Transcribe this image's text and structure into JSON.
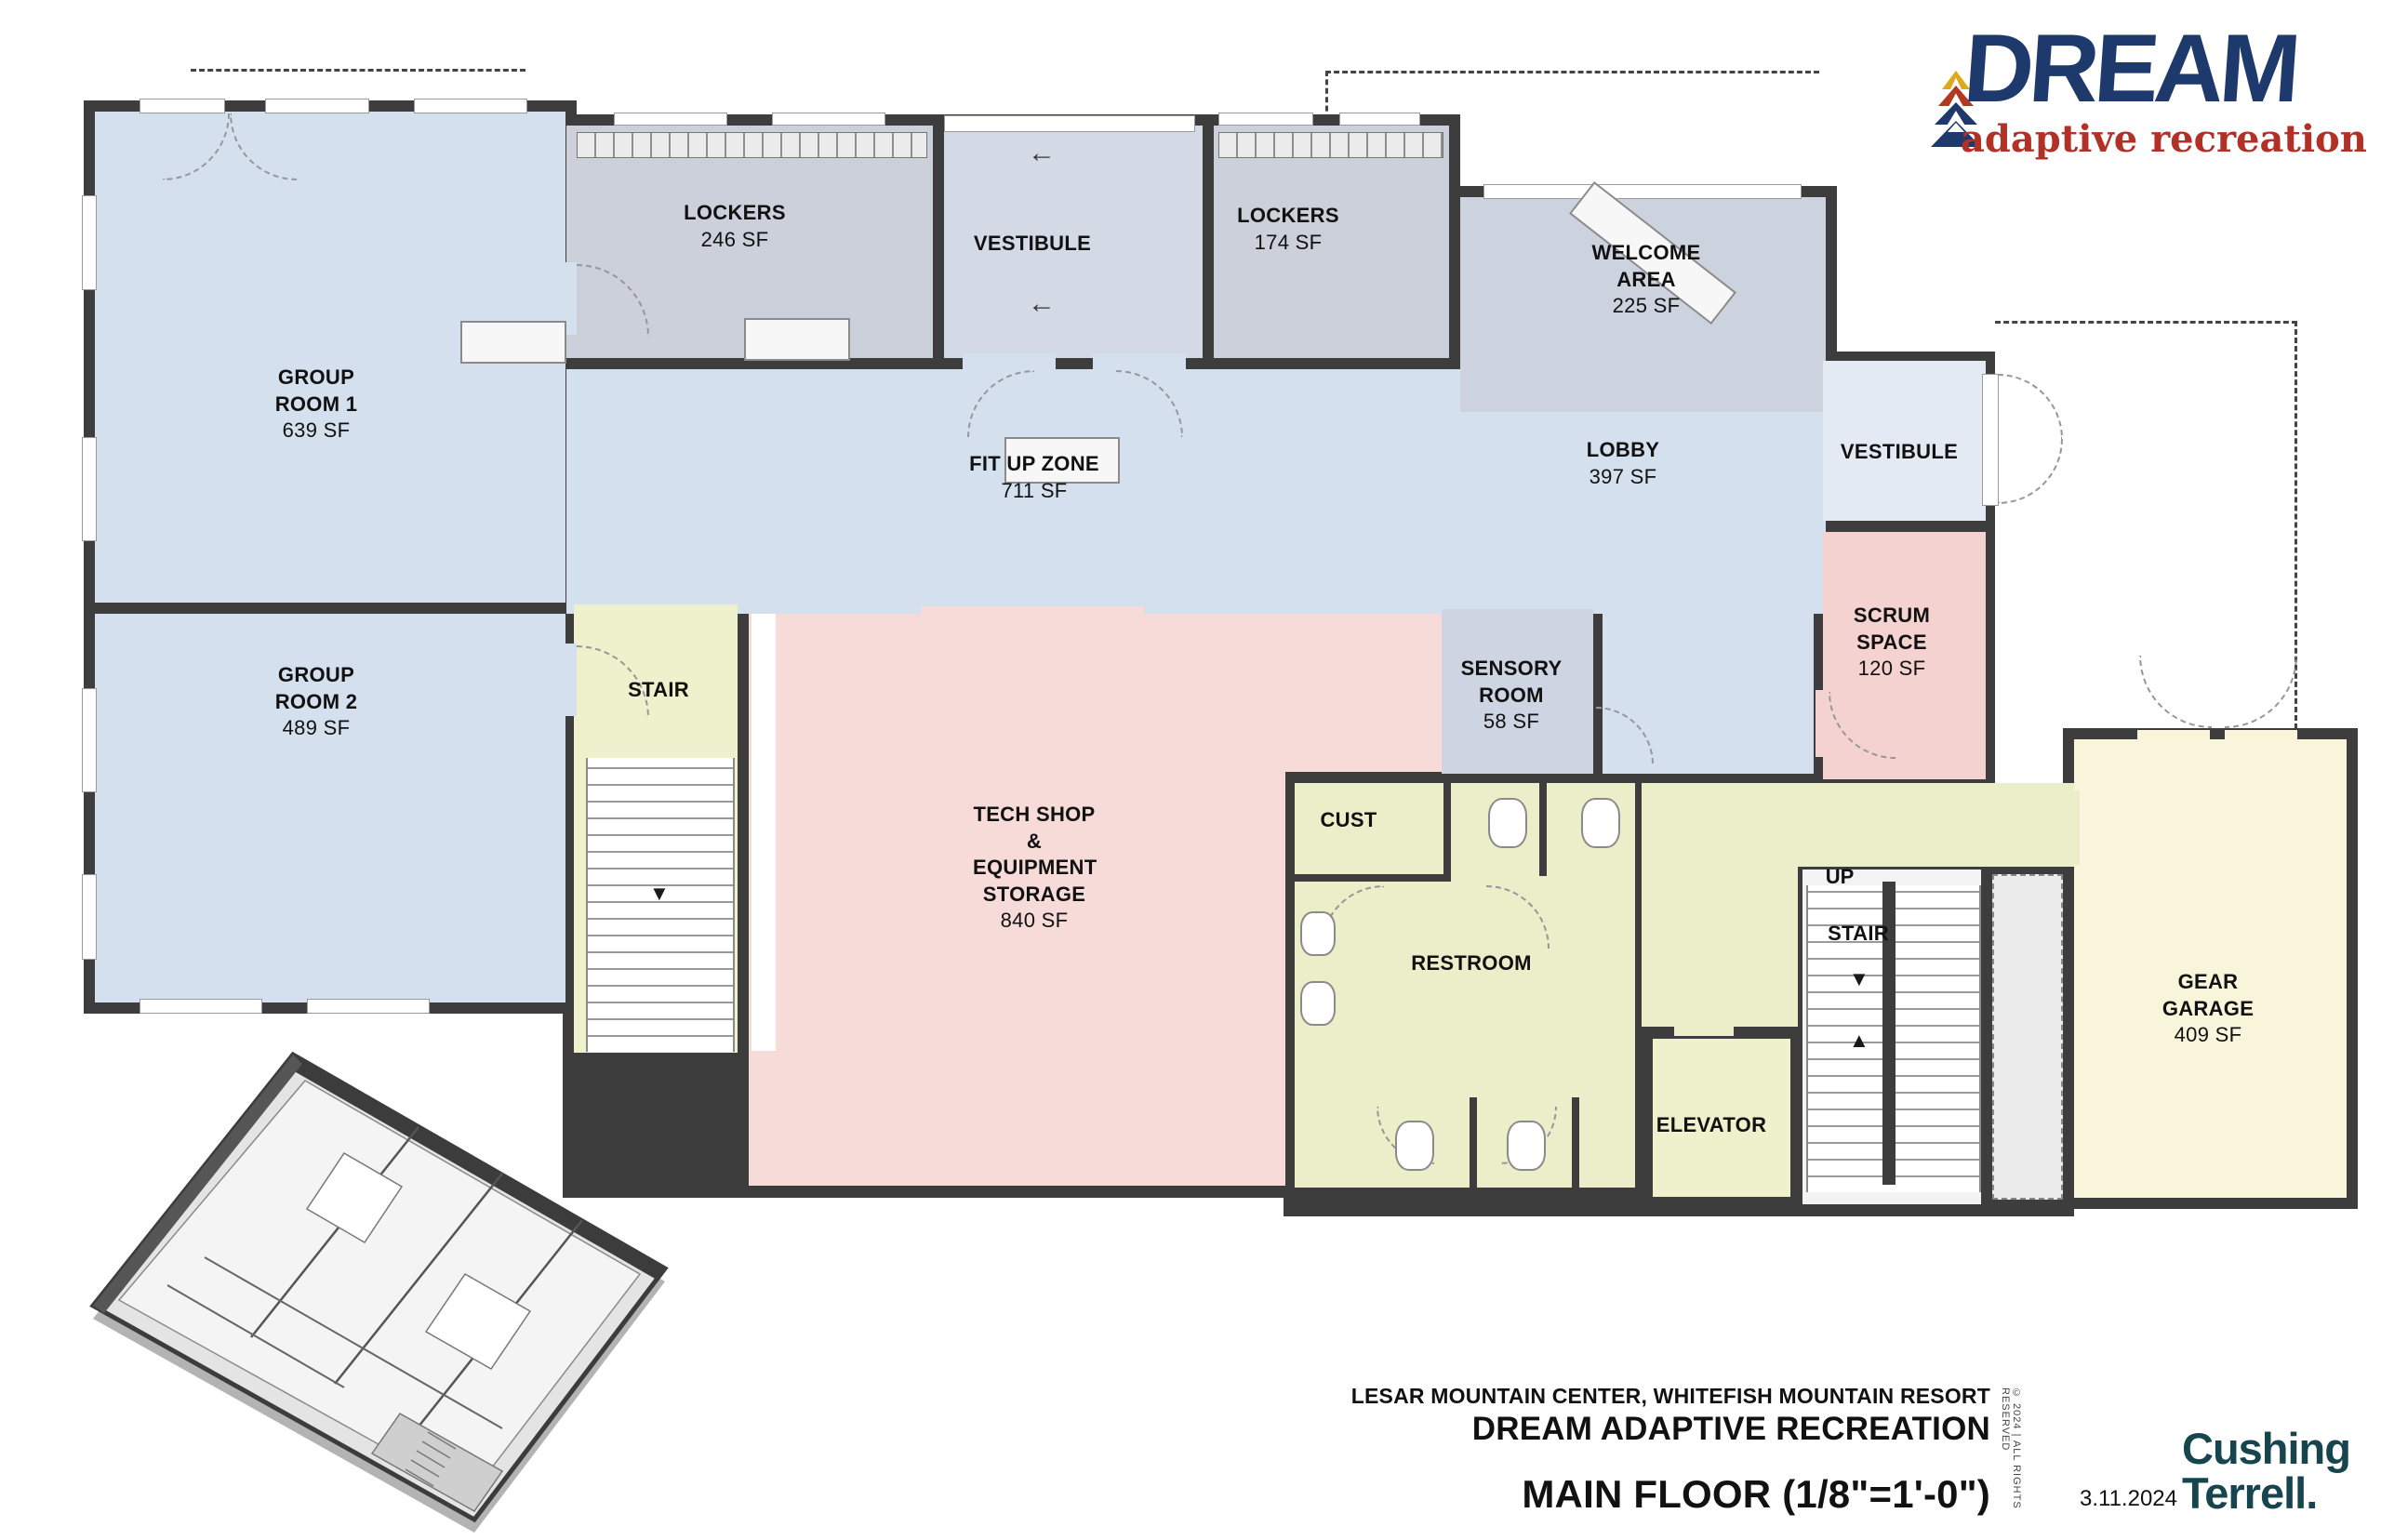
{
  "logo": {
    "brand": "DREAM",
    "tagline": "adaptive recreation"
  },
  "rooms": {
    "group_room_1": {
      "name": "GROUP ROOM 1",
      "area": "639 SF"
    },
    "group_room_2": {
      "name": "GROUP ROOM 2",
      "area": "489 SF"
    },
    "lockers_a": {
      "name": "LOCKERS",
      "area": "246 SF"
    },
    "vestibule_top": {
      "name": "VESTIBULE"
    },
    "lockers_b": {
      "name": "LOCKERS",
      "area": "174 SF"
    },
    "welcome_area": {
      "name": "WELCOME AREA",
      "area": "225 SF"
    },
    "fit_up_zone": {
      "name": "FIT UP ZONE",
      "area": "711 SF"
    },
    "lobby": {
      "name": "LOBBY",
      "area": "397 SF"
    },
    "vestibule_right": {
      "name": "VESTIBULE"
    },
    "stair_left": {
      "name": "STAIR"
    },
    "scrum_space": {
      "name": "SCRUM SPACE",
      "area": "120 SF"
    },
    "sensory_room": {
      "name": "SENSORY ROOM",
      "area": "58 SF"
    },
    "tech_shop": {
      "name": "TECH SHOP & EQUIPMENT STORAGE",
      "area": "840 SF"
    },
    "cust": {
      "name": "CUST"
    },
    "restroom": {
      "name": "RESTROOM"
    },
    "stair_right": {
      "name": "STAIR",
      "direction": "UP"
    },
    "elevator": {
      "name": "ELEVATOR"
    },
    "gear_garage": {
      "name": "GEAR GARAGE",
      "area": "409 SF"
    }
  },
  "icons": {
    "left_arrow": "←",
    "down_arrow": "▼",
    "up_arrow": "▲"
  },
  "title_block": {
    "project": "LESAR MOUNTAIN CENTER, WHITEFISH MOUNTAIN RESORT",
    "client": "DREAM ADAPTIVE RECREATION",
    "sheet_title": "MAIN FLOOR (1/8\"=1'-0\")",
    "date": "3.11.2024",
    "copyright": "© 2024  |  ALL RIGHTS RESERVED",
    "firm_line1": "Cushing",
    "firm_line2": "Terrell."
  },
  "colors": {
    "wall": "#3d3d3d",
    "room_blue": "#d5e0ef",
    "room_gray": "#cbd0da",
    "room_grayblue": "#d3d9e5",
    "room_welcome": "#ccd2de",
    "room_sensory": "#cdd5e3",
    "room_vest_right": "#e4eaf3",
    "room_pink": "#f7dbd9",
    "room_scrum": "#f4d2d0",
    "room_khaki": "#ecedc9",
    "room_yellow": "#eff0cc",
    "room_paleyellow": "#f9f5da",
    "room_white": "#f3f3f3",
    "shaft_gray": "#ececec",
    "logo_navy": "#1e3a6d",
    "logo_red": "#b23127",
    "logo_yellow": "#dfa91c",
    "logo_orange": "#b0391f",
    "firm_teal": "#17454e"
  }
}
